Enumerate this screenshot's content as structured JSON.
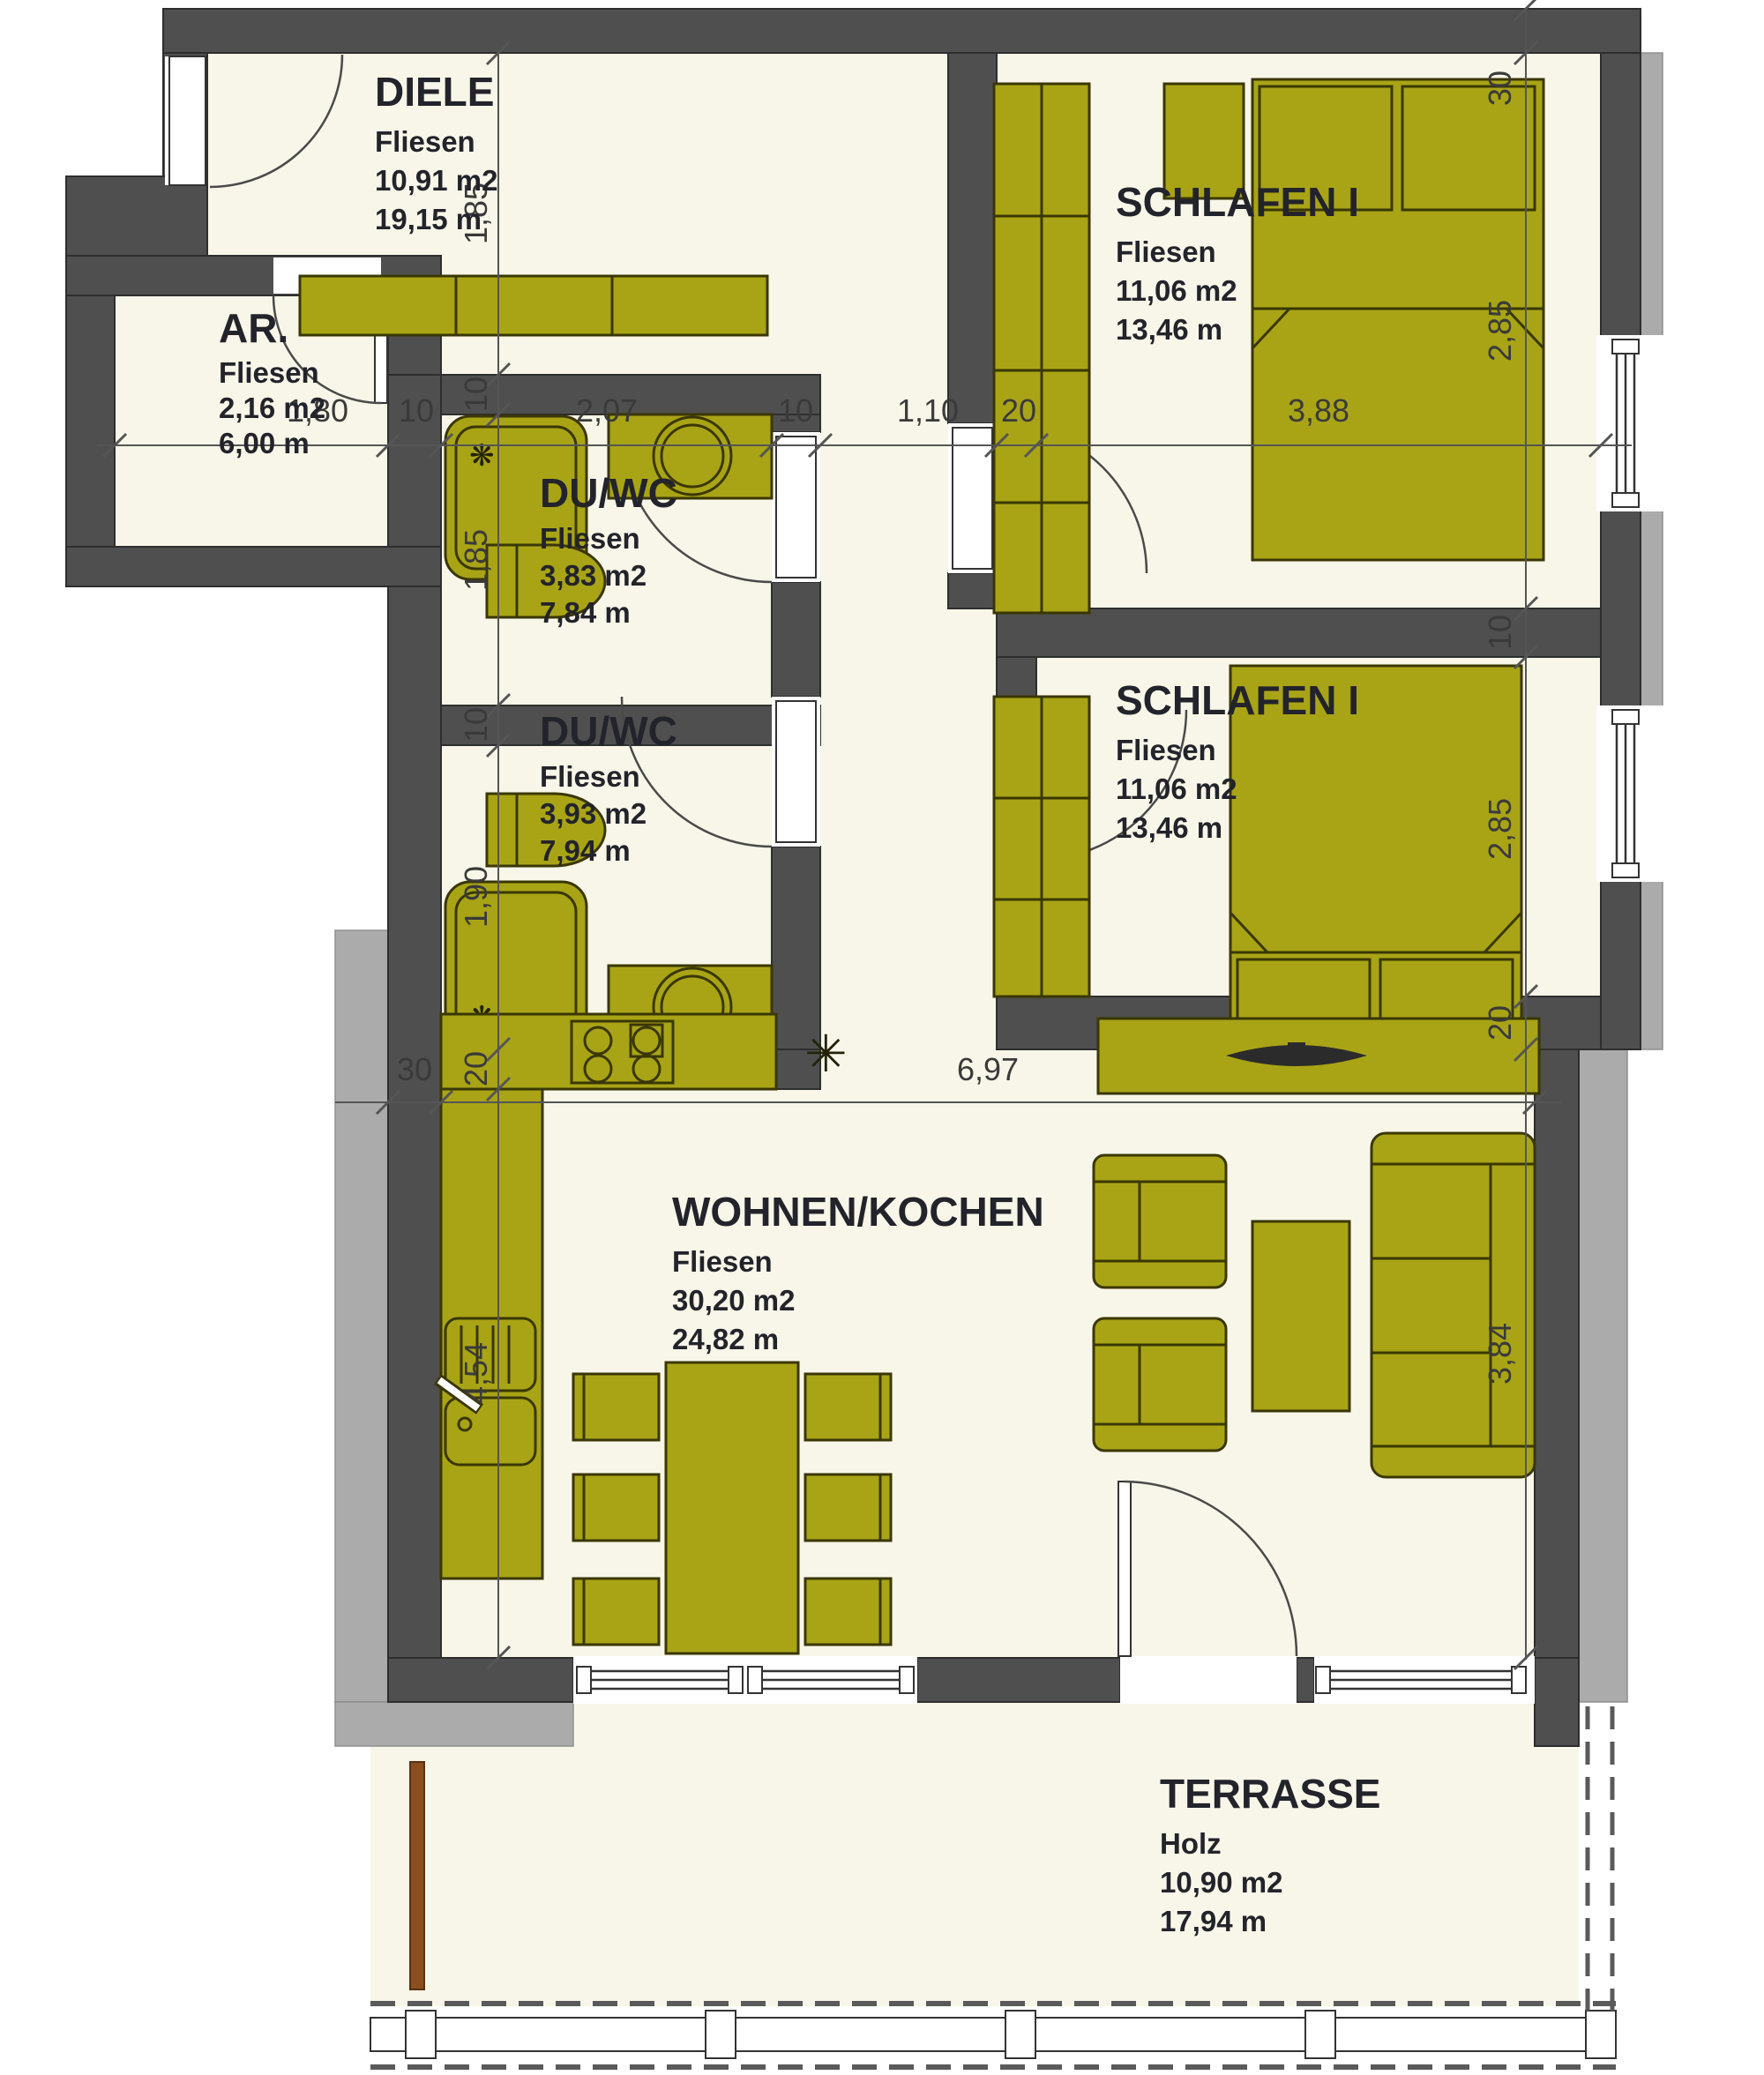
{
  "plan": {
    "rooms": [
      {
        "id": "diele",
        "name": "DIELE",
        "material": "Fliesen",
        "area": "10,91 m2",
        "perimeter": "19,15 m"
      },
      {
        "id": "schlafen-1-top",
        "name": "SCHLAFEN I",
        "material": "Fliesen",
        "area": "11,06 m2",
        "perimeter": "13,46 m"
      },
      {
        "id": "abstellraum",
        "name": "AR.",
        "material": "Fliesen",
        "area": "2,16 m2",
        "perimeter": "6,00 m"
      },
      {
        "id": "du-wc-1",
        "name": "DU/WC",
        "material": "Fliesen",
        "area": "3,83 m2",
        "perimeter": "7,84 m"
      },
      {
        "id": "du-wc-2",
        "name": "DU/WC",
        "material": "Fliesen",
        "area": "3,93 m2",
        "perimeter": "7,94 m"
      },
      {
        "id": "schlafen-1-bottom",
        "name": "SCHLAFEN I",
        "material": "Fliesen",
        "area": "11,06 m2",
        "perimeter": "13,46 m"
      },
      {
        "id": "wohnen-kochen",
        "name": "WOHNEN/KOCHEN",
        "material": "Fliesen",
        "area": "30,20 m2",
        "perimeter": "24,82 m"
      },
      {
        "id": "terrasse",
        "name": "TERRASSE",
        "material": "Holz",
        "area": "10,90 m2",
        "perimeter": "17,94 m"
      }
    ],
    "dimensions": {
      "top": [
        "1,80",
        "10",
        "2,07",
        "10",
        "1,10",
        "20",
        "3,88"
      ],
      "left": [
        "1,85",
        "10",
        "1,85",
        "10",
        "1,90",
        "20",
        "4,54"
      ],
      "right": [
        "30",
        "2,85",
        "10",
        "2,85",
        "20",
        "3,84"
      ],
      "middle": [
        "30",
        "6,97"
      ]
    },
    "colors": {
      "wall": "#4F4F4F",
      "outer_band": "#ABABAB",
      "floor": "#F8F6E8",
      "furniture": "#A8A416",
      "wood_post": "#8B4E1E",
      "text": "#23232B"
    },
    "icons": {
      "kitchen_star": "✳",
      "shower_head": "❋"
    }
  }
}
